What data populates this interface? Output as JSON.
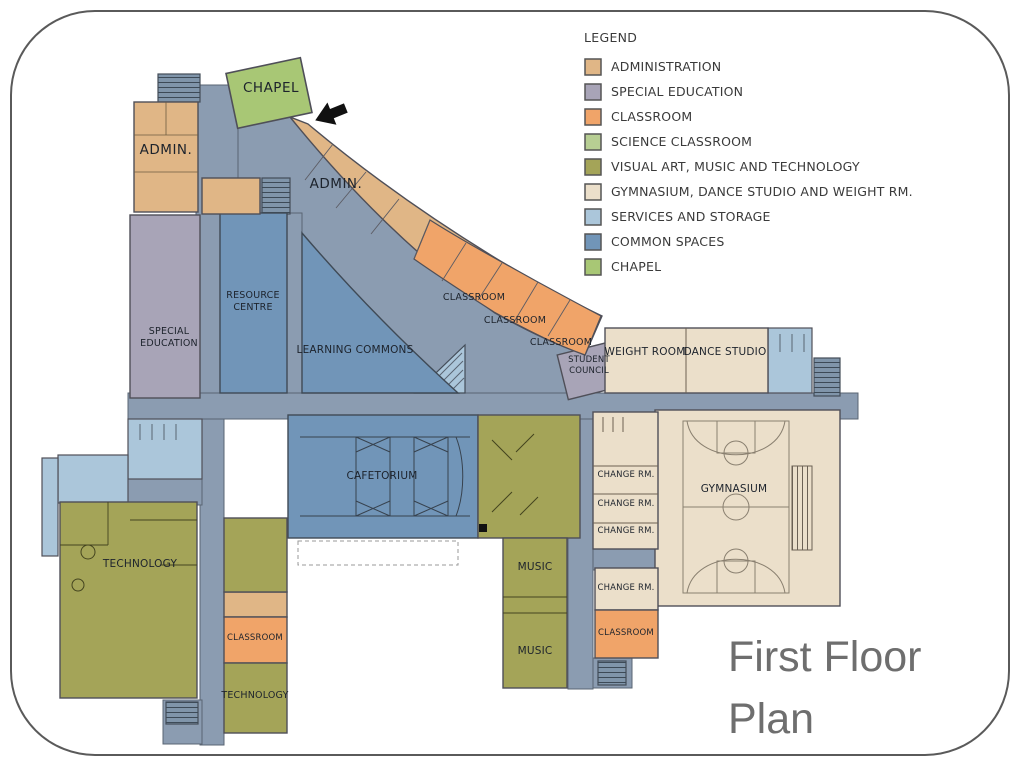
{
  "slide": {
    "title": "First Floor\nPlan"
  },
  "legend": {
    "title": "LEGEND",
    "items": [
      {
        "label": "ADMINISTRATION",
        "color": "#e0b686"
      },
      {
        "label": "SPECIAL EDUCATION",
        "color": "#a8a4b7"
      },
      {
        "label": "CLASSROOM",
        "color": "#f0a469"
      },
      {
        "label": "SCIENCE CLASSROOM",
        "color": "#b7ce93"
      },
      {
        "label": "VISUAL ART, MUSIC AND TECHNOLOGY",
        "color": "#a4a458"
      },
      {
        "label": "GYMNASIUM, DANCE STUDIO AND WEIGHT RM.",
        "color": "#ebdfca"
      },
      {
        "label": "SERVICES AND STORAGE",
        "color": "#abc6da"
      },
      {
        "label": "COMMON SPACES",
        "color": "#7195b8"
      },
      {
        "label": "CHAPEL",
        "color": "#a8c775"
      }
    ]
  },
  "colors": {
    "administration": "#e0b686",
    "special_education": "#a8a4b7",
    "classroom": "#f0a469",
    "science_classroom": "#b7ce93",
    "visual_art_music_tech": "#a4a458",
    "gymnasium": "#ebdfca",
    "services_storage": "#abc6da",
    "common_spaces": "#7195b8",
    "chapel": "#a8c775",
    "corridor": "#8b9cb1",
    "stairwell": "#8095aa",
    "wall": "#4f4f58",
    "title_text": "#6e6e6e"
  },
  "plan": {
    "labels": {
      "chapel": "CHAPEL",
      "admin_west": "ADMIN.",
      "admin_arc": "ADMIN.",
      "special_education": "SPECIAL\nEDUCATION",
      "resource_centre": "RESOURCE\nCENTRE",
      "learning_commons": "LEARNING COMMONS",
      "classroom_arc_1": "CLASSROOM",
      "classroom_arc_2": "CLASSROOM",
      "classroom_arc_3": "CLASSROOM",
      "student_council": "STUDENT\nCOUNCIL",
      "weight_room": "WEIGHT ROOM",
      "dance_studio": "DANCE STUDIO",
      "gymnasium": "GYMNASIUM",
      "change_rm_1": "CHANGE RM.",
      "change_rm_2": "CHANGE RM.",
      "change_rm_3": "CHANGE RM.",
      "change_rm_4": "CHANGE RM.",
      "classroom_east": "CLASSROOM",
      "cafetorium": "CAFETORIUM",
      "music_1": "MUSIC",
      "music_2": "MUSIC",
      "technology_west": "TECHNOLOGY",
      "classroom_south": "CLASSROOM",
      "technology_south": "TECHNOLOGY"
    }
  }
}
